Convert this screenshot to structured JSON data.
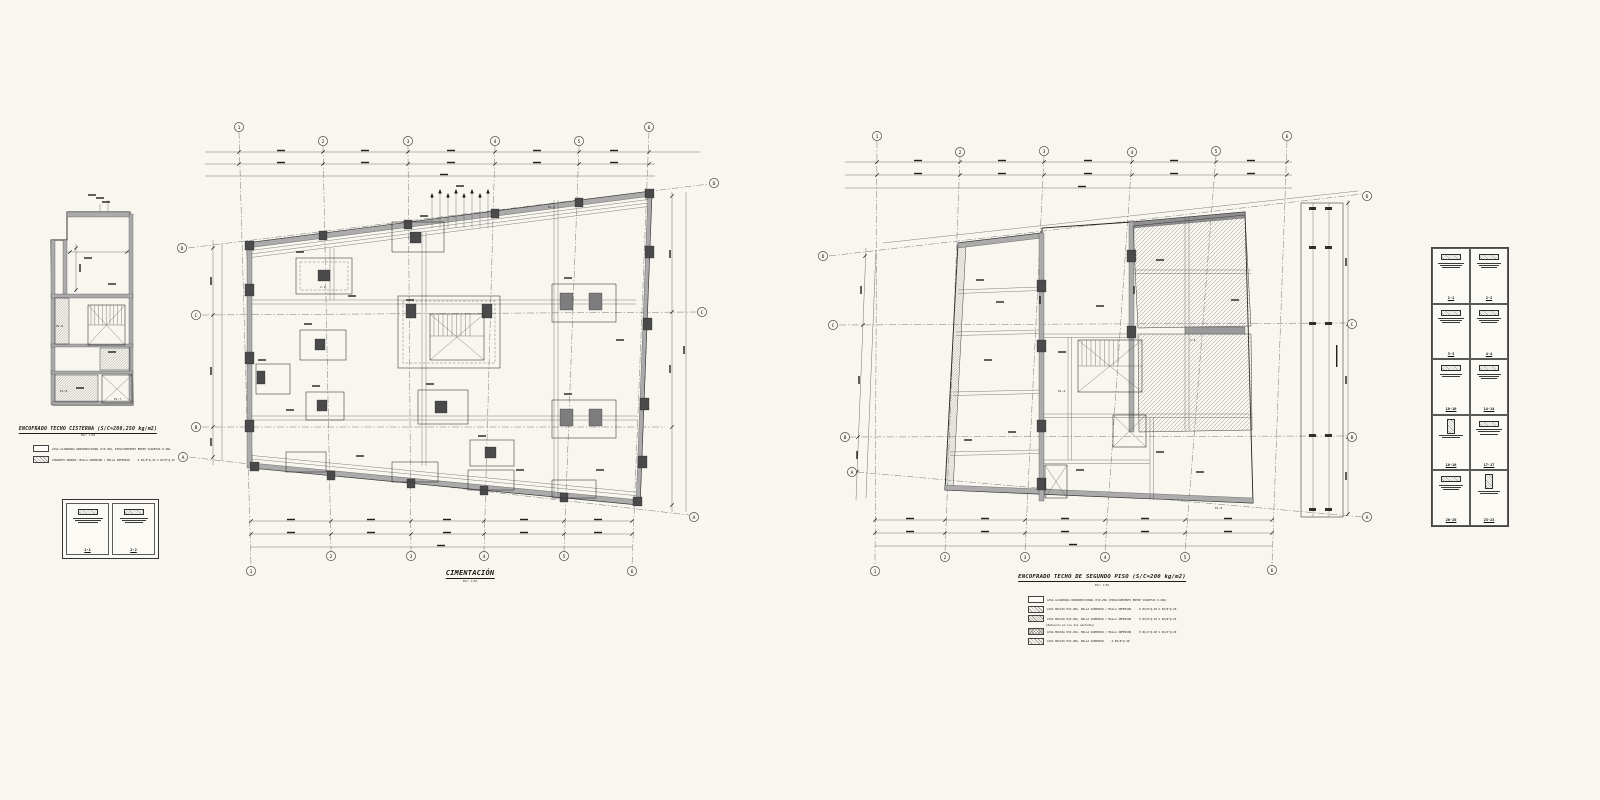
{
  "colors": {
    "paper": "#f8f6ef",
    "ink": "#1f1f1f"
  },
  "cisterna": {
    "title": "ENCOFRADO TECHO CISTERNA (S/C=200,250 kg/m2)",
    "scale": "ESC: 1/50",
    "legend": [
      {
        "swatch": "plain",
        "text": "LOSA ALIGERADA UNIDIRECCIONAL H=0.20m. ESPACIAMIENTO ENTRE VIGUETAS 0.40m.",
        "spec": ""
      },
      {
        "swatch": "hatch",
        "text": "CONCRETO ARMADO: MALLA SUPERIOR / MALLA INFERIOR",
        "spec": "E Ø3/8\"@.25   S Ø3/8\"@.25"
      }
    ],
    "sections": [
      {
        "label": "1-1"
      },
      {
        "label": "2-2"
      }
    ]
  },
  "cimentacion": {
    "title": "CIMENTACIÓN",
    "scale": "ESC: 1/50",
    "cols": [
      "1",
      "2",
      "3",
      "4",
      "5",
      "6"
    ],
    "rows": [
      "D",
      "C",
      "B",
      "A"
    ]
  },
  "segundo": {
    "title": "ENCOFRADO TECHO DE SEGUNDO PISO (S/C=200 kg/m2)",
    "scale": "ESC: 1/50",
    "cols": [
      "1",
      "2",
      "3",
      "4",
      "5",
      "6"
    ],
    "rows": [
      "D",
      "C",
      "B",
      "A"
    ],
    "legend": [
      {
        "swatch": "plain",
        "text": "LOSA ALIGERADA UNIDIRECCIONAL H=0.20m (ESPACIAMIENTO ENTRE VIGUETAS 0.40m)",
        "spec": ""
      },
      {
        "swatch": "hatch",
        "text": "LOSA MACIZA H=0.20m, MALLA SUPERIOR / MALLA INFERIOR",
        "spec": "E Ø3/8\"@.20   S Ø3/8\"@.20"
      },
      {
        "swatch": "hatch2",
        "text": "LOSA MACIZA H=0.20m, MALLA SUPERIOR / MALLA INFERIOR",
        "spec": "E Ø3/8\"@.25   S Ø3/8\"@.25"
      },
      {
        "swatch": "none",
        "text": "(Refuerzo en los dos sentidos)",
        "spec": ""
      },
      {
        "swatch": "cross",
        "text": "LOSA MACIZA H=0.25m, MALLA SUPERIOR / MALLA INFERIOR",
        "spec": "E Ø1/2\"@.20   S Ø1/2\"@.20"
      },
      {
        "swatch": "hatch",
        "text": "LOSA MACIZA H=0.20m, MALLA SUPERIOR",
        "spec": "S Ø3/8\"@.20"
      }
    ]
  },
  "details": {
    "sections": [
      {
        "label": "1-1"
      },
      {
        "label": "2-2"
      },
      {
        "label": "3-3"
      },
      {
        "label": "4-4"
      },
      {
        "label": "10-10"
      },
      {
        "label": "14-14"
      },
      {
        "label": "16-16"
      },
      {
        "label": "17-17"
      },
      {
        "label": "20-20"
      },
      {
        "label": "23-23"
      }
    ]
  },
  "labels": {
    "pl1": "PL-1",
    "pl4": "PL-4",
    "pl6": "PL-6",
    "pl7": "PL-7",
    "pl8": "PL-8",
    "pl9": "PL-9",
    "c1": "C-1",
    "c4": "C-4"
  }
}
